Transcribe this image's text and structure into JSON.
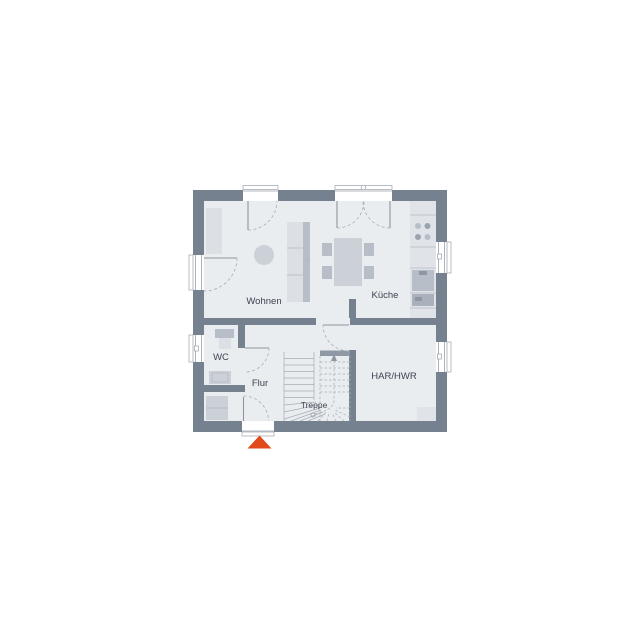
{
  "plan": {
    "rooms": {
      "wohnen": {
        "label": "Wohnen"
      },
      "kueche": {
        "label": "Küche"
      },
      "wc": {
        "label": "WC"
      },
      "flur": {
        "label": "Flur"
      },
      "treppe": {
        "label": "Treppe"
      },
      "har_hwr": {
        "label": "HAR/HWR"
      }
    },
    "entrance_marker": "entrance-arrow"
  },
  "colors": {
    "background": "#ffffff",
    "wall": "#76818f",
    "floor": "#eaedf0",
    "furniture_light": "#dcdfe4",
    "furniture_mid": "#ccd1d8",
    "furniture_dark": "#b7bec7",
    "line": "#9aa1aa",
    "text": "#3d4451",
    "accent": "#e24a1c"
  }
}
